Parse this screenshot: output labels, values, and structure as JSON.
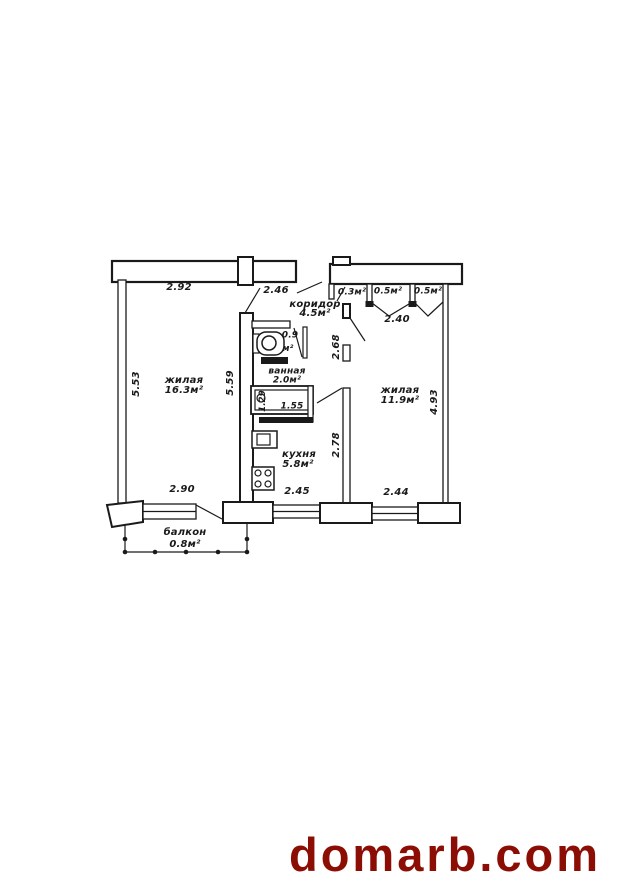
{
  "watermark": {
    "text": "domarb.com",
    "color": "#8b0d04"
  },
  "colors": {
    "ink": "#1a1a1a",
    "paper": "#ffffff"
  },
  "plan": {
    "type": "apartment floor plan",
    "rooms": {
      "living_left": {
        "name": "жилая",
        "area": "16.3м²"
      },
      "living_right": {
        "name": "жилая",
        "area": "11.9м²"
      },
      "kitchen": {
        "name": "кухня",
        "area": "5.8м²"
      },
      "bathroom": {
        "name": "ванная",
        "area": "2.0м²"
      },
      "toilet": {
        "area": "0.9",
        "unit": "м²"
      },
      "corridor": {
        "name": "коридор",
        "area": "4.5м²"
      },
      "balcony": {
        "name": "балкон",
        "area": "0.8м²"
      },
      "closet_1": {
        "area": "0.3м²"
      },
      "closet_2": {
        "area": "0.5м²"
      },
      "closet_3": {
        "area": "0.5м²"
      }
    },
    "dims": {
      "top_left_width": "2.92",
      "top_right_width": "2.46",
      "closets_width": "2.40",
      "left_height": "5.53",
      "left_room_height": "5.59",
      "right_height": "4.93",
      "corridor_height": "2.68",
      "kitchen_height": "2.78",
      "bath_width": "1.55",
      "bath_depth": "1.29",
      "bottom_left_width": "2.90",
      "bottom_mid_width": "2.45",
      "bottom_right_width": "2.44"
    }
  }
}
